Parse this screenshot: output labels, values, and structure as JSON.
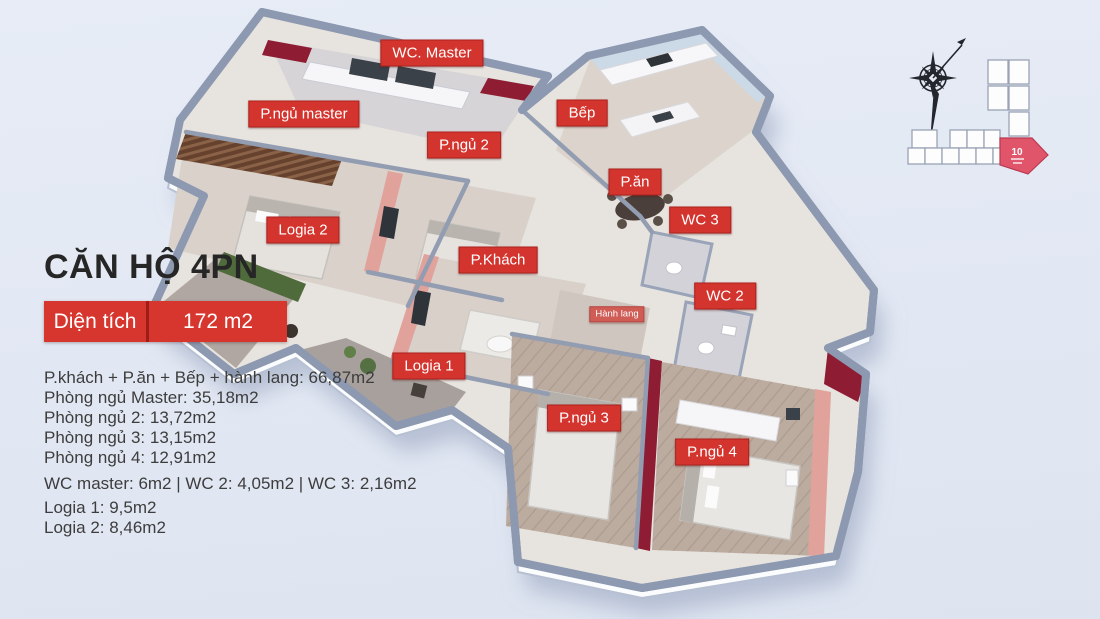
{
  "panel": {
    "title": "CĂN HỘ 4PN",
    "area_label": "Diện tích",
    "area_value": "172 m2",
    "lines": [
      "P.khách + P.ăn + Bếp + hành lang: 66,87m2",
      "Phòng ngủ Master: 35,18m2",
      "Phòng ngủ 2: 13,72m2",
      "Phòng ngủ 3: 13,15m2",
      "Phòng ngủ 4: 12,91m2",
      "WC master: 6m2 | WC 2: 4,05m2 | WC 3: 2,16m2",
      "Logia 1: 9,5m2",
      "Logia 2: 8,46m2"
    ]
  },
  "floorplan": {
    "labels": [
      {
        "id": "wc-master",
        "text": "WC. Master",
        "x": 432,
        "y": 53,
        "size": "md"
      },
      {
        "id": "pngu-master",
        "text": "P.ngủ master",
        "x": 304,
        "y": 114,
        "size": "md"
      },
      {
        "id": "bep",
        "text": "Bếp",
        "x": 582,
        "y": 113,
        "size": "md"
      },
      {
        "id": "pngu-2",
        "text": "P.ngủ 2",
        "x": 464,
        "y": 145,
        "size": "md"
      },
      {
        "id": "pan",
        "text": "P.ăn",
        "x": 635,
        "y": 182,
        "size": "md"
      },
      {
        "id": "wc-3",
        "text": "WC 3",
        "x": 700,
        "y": 220,
        "size": "md"
      },
      {
        "id": "logia-2",
        "text": "Logia 2",
        "x": 303,
        "y": 230,
        "size": "md"
      },
      {
        "id": "pkhach",
        "text": "P.Khách",
        "x": 498,
        "y": 260,
        "size": "md"
      },
      {
        "id": "wc-2",
        "text": "WC 2",
        "x": 725,
        "y": 296,
        "size": "md"
      },
      {
        "id": "hanh-lang",
        "text": "Hành lang",
        "x": 617,
        "y": 314,
        "size": "sm"
      },
      {
        "id": "logia-1",
        "text": "Logia 1",
        "x": 429,
        "y": 366,
        "size": "md"
      },
      {
        "id": "pngu-3",
        "text": "P.ngủ 3",
        "x": 584,
        "y": 418,
        "size": "md"
      },
      {
        "id": "pngu-4",
        "text": "P.ngủ 4",
        "x": 712,
        "y": 452,
        "size": "md"
      }
    ]
  },
  "siteplan": {
    "unit_number": "10"
  },
  "colors": {
    "background": "#e2e8f3",
    "label_red": "#d4342e",
    "area_box_red": "#d7362f",
    "dark_red_wall": "#8e1d33",
    "pink_wall": "#e0a29a",
    "wall_gray": "#8d99b0",
    "highlight_unit": "#e0556a",
    "green_wall": "#4f6b3c"
  }
}
